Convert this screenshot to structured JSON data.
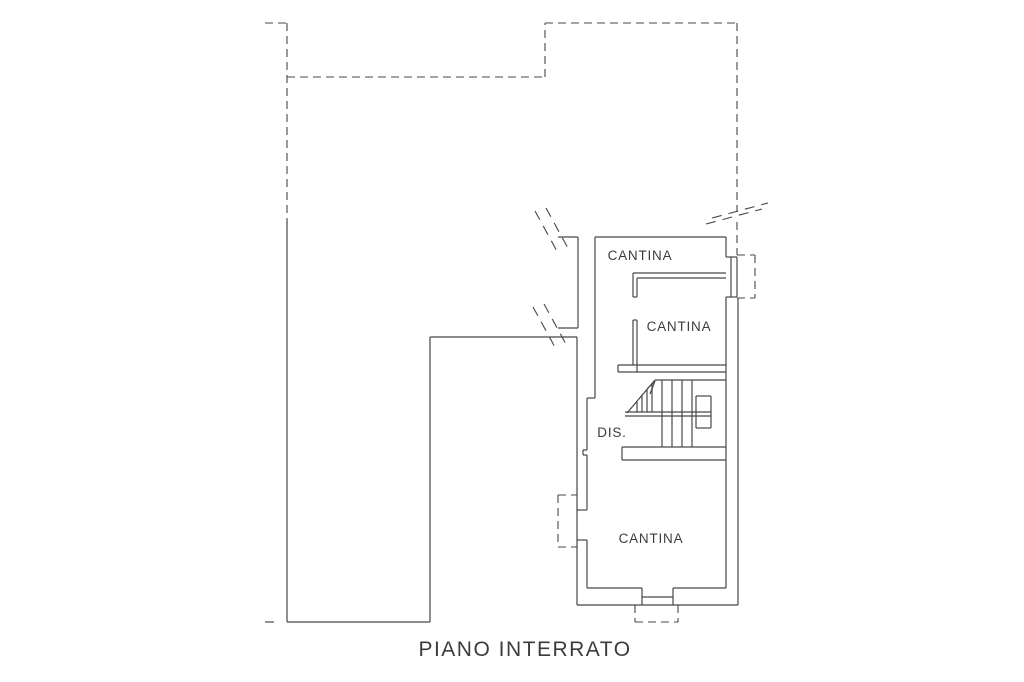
{
  "title": "PIANO INTERRATO",
  "colors": {
    "background": "#ffffff",
    "line": "#474747",
    "text": "#3c3c3c"
  },
  "rooms": [
    {
      "id": "cantina-top",
      "label": "CANTINA",
      "x": 640,
      "y": 260,
      "size": 13.5
    },
    {
      "id": "cantina-middle",
      "label": "CANTINA",
      "x": 679,
      "y": 331,
      "size": 13.5
    },
    {
      "id": "cantina-bottom",
      "label": "CANTINA",
      "x": 651,
      "y": 543,
      "size": 13.5
    },
    {
      "id": "dis-corridor",
      "label": "DIS.",
      "x": 612,
      "y": 437,
      "size": 13.5
    }
  ],
  "drawing": {
    "solid_lines": [
      [
        287,
        220,
        287,
        622
      ],
      [
        287,
        622,
        430,
        622
      ],
      [
        430,
        622,
        430,
        337
      ],
      [
        430,
        337,
        577,
        337
      ],
      [
        265,
        622,
        274,
        622
      ],
      [
        558,
        237,
        578,
        237
      ],
      [
        578,
        237,
        578,
        328
      ],
      [
        558,
        328,
        578,
        328
      ],
      [
        595,
        237,
        726,
        237
      ],
      [
        726,
        237,
        726,
        257
      ],
      [
        726,
        297,
        726,
        588
      ],
      [
        738,
        298,
        738,
        605
      ],
      [
        577,
        605,
        738,
        605
      ],
      [
        577,
        337,
        577,
        605
      ],
      [
        595,
        237,
        595,
        398
      ],
      [
        595,
        398,
        587,
        398
      ],
      [
        587,
        398,
        587,
        450
      ],
      [
        587,
        450,
        583,
        450
      ],
      [
        583,
        450,
        583,
        455
      ],
      [
        583,
        455,
        587,
        455
      ],
      [
        587,
        455,
        587,
        510
      ],
      [
        587,
        540,
        587,
        588
      ],
      [
        587,
        588,
        642,
        588
      ],
      [
        673,
        588,
        726,
        588
      ],
      [
        577,
        510,
        587,
        510
      ],
      [
        577,
        540,
        587,
        540
      ],
      [
        726,
        257,
        737,
        257
      ],
      [
        726,
        297,
        737,
        297
      ],
      [
        737,
        257,
        737,
        297
      ],
      [
        731,
        257,
        731,
        297
      ],
      [
        642,
        588,
        642,
        605
      ],
      [
        673,
        588,
        673,
        605
      ],
      [
        642,
        597,
        673,
        597
      ],
      [
        633,
        273,
        726,
        273
      ],
      [
        637,
        278,
        726,
        278
      ],
      [
        633,
        273,
        633,
        297
      ],
      [
        637,
        278,
        637,
        297
      ],
      [
        633,
        297,
        637,
        297
      ],
      [
        633,
        320,
        633,
        365
      ],
      [
        637,
        320,
        637,
        372
      ],
      [
        633,
        320,
        637,
        320
      ],
      [
        618,
        365,
        726,
        365
      ],
      [
        618,
        372,
        726,
        372
      ],
      [
        618,
        365,
        618,
        372
      ],
      [
        655,
        380,
        726,
        380
      ],
      [
        622,
        447,
        726,
        447
      ],
      [
        622,
        447,
        622,
        460
      ],
      [
        622,
        460,
        726,
        460
      ],
      [
        662,
        380,
        662,
        447
      ],
      [
        672,
        380,
        672,
        447
      ],
      [
        682,
        380,
        682,
        447
      ],
      [
        692,
        380,
        692,
        447
      ],
      [
        696,
        396,
        711,
        396
      ],
      [
        711,
        396,
        711,
        428
      ],
      [
        696,
        428,
        711,
        428
      ],
      [
        696,
        396,
        696,
        428
      ],
      [
        625,
        412,
        711,
        412
      ],
      [
        625,
        416,
        711,
        416
      ],
      [
        627,
        413,
        655,
        380
      ],
      [
        637,
        402,
        637,
        412
      ],
      [
        642,
        396,
        642,
        412
      ],
      [
        647,
        390,
        647,
        412
      ],
      [
        652,
        384,
        652,
        412
      ],
      [
        655,
        381,
        647,
        389
      ],
      [
        655,
        381,
        650,
        394
      ]
    ],
    "dashed_lines": [
      [
        265,
        23,
        287,
        23
      ],
      [
        287,
        23,
        287,
        220
      ],
      [
        287,
        77,
        545,
        77
      ],
      [
        545,
        77,
        545,
        23
      ],
      [
        545,
        23,
        737,
        23
      ],
      [
        737,
        23,
        737,
        212
      ],
      [
        737,
        222,
        737,
        255
      ],
      [
        737,
        255,
        755,
        255
      ],
      [
        755,
        255,
        755,
        298
      ],
      [
        737,
        298,
        755,
        298
      ],
      [
        558,
        495,
        577,
        495
      ],
      [
        558,
        495,
        558,
        547
      ],
      [
        558,
        547,
        577,
        547
      ],
      [
        635,
        605,
        635,
        622
      ],
      [
        635,
        622,
        678,
        622
      ],
      [
        678,
        605,
        678,
        622
      ]
    ],
    "break_marks": [
      [
        535,
        211,
        558,
        253
      ],
      [
        546,
        208,
        569,
        250
      ],
      [
        533,
        307,
        556,
        349
      ],
      [
        544,
        304,
        567,
        346
      ],
      [
        706,
        224,
        762,
        209
      ],
      [
        712,
        218,
        768,
        203
      ]
    ]
  }
}
